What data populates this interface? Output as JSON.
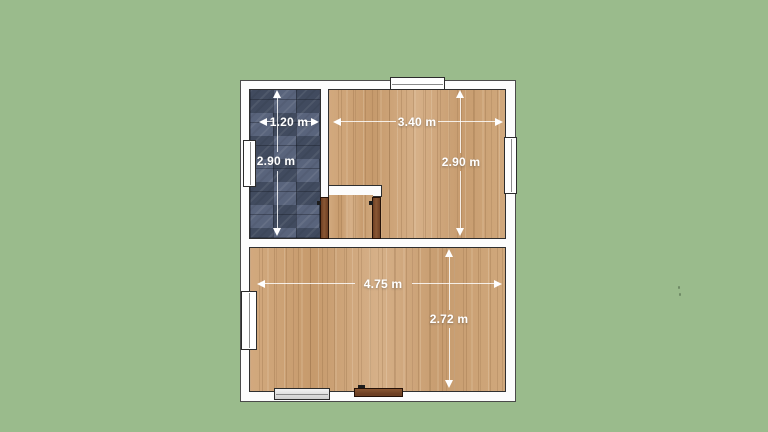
{
  "view": {
    "type": "floor-plan-render",
    "background_color": "#9abb8c"
  },
  "palette": {
    "wall_fill": "#fcfcfc",
    "outline": "#2f2f2f",
    "wood_floor_base": "#cda57a",
    "tile_floor_base": "#4a5469",
    "door_fill": "#7a4a2b",
    "window_fill": "#ffffff",
    "dimension_color": "#ffffff"
  },
  "rooms": [
    {
      "id": "bathroom",
      "floor": "dark-blue-tile",
      "width_label": "1.20 m",
      "depth_label": "2.90 m"
    },
    {
      "id": "bedroom",
      "floor": "wood-plank",
      "width_label": "3.40 m",
      "depth_label": "2.90 m"
    },
    {
      "id": "living-room",
      "floor": "wood-plank",
      "width_label": "4.75 m",
      "depth_label": "2.72 m"
    },
    {
      "id": "hallway",
      "floor": "wood-plank"
    }
  ],
  "dimensions": {
    "bathroom_width": "1.20 m",
    "bathroom_depth": "2.90 m",
    "bedroom_width": "3.40 m",
    "bedroom_depth": "2.90 m",
    "living_width": "4.75 m",
    "living_depth": "2.72 m"
  },
  "openings": {
    "windows": [
      "top-wall",
      "bathroom-left-wall",
      "bedroom-right-wall",
      "living-left-wall",
      "living-bottom-wall"
    ],
    "doors": [
      "bathroom-door",
      "bedroom-door",
      "entry-door"
    ]
  }
}
